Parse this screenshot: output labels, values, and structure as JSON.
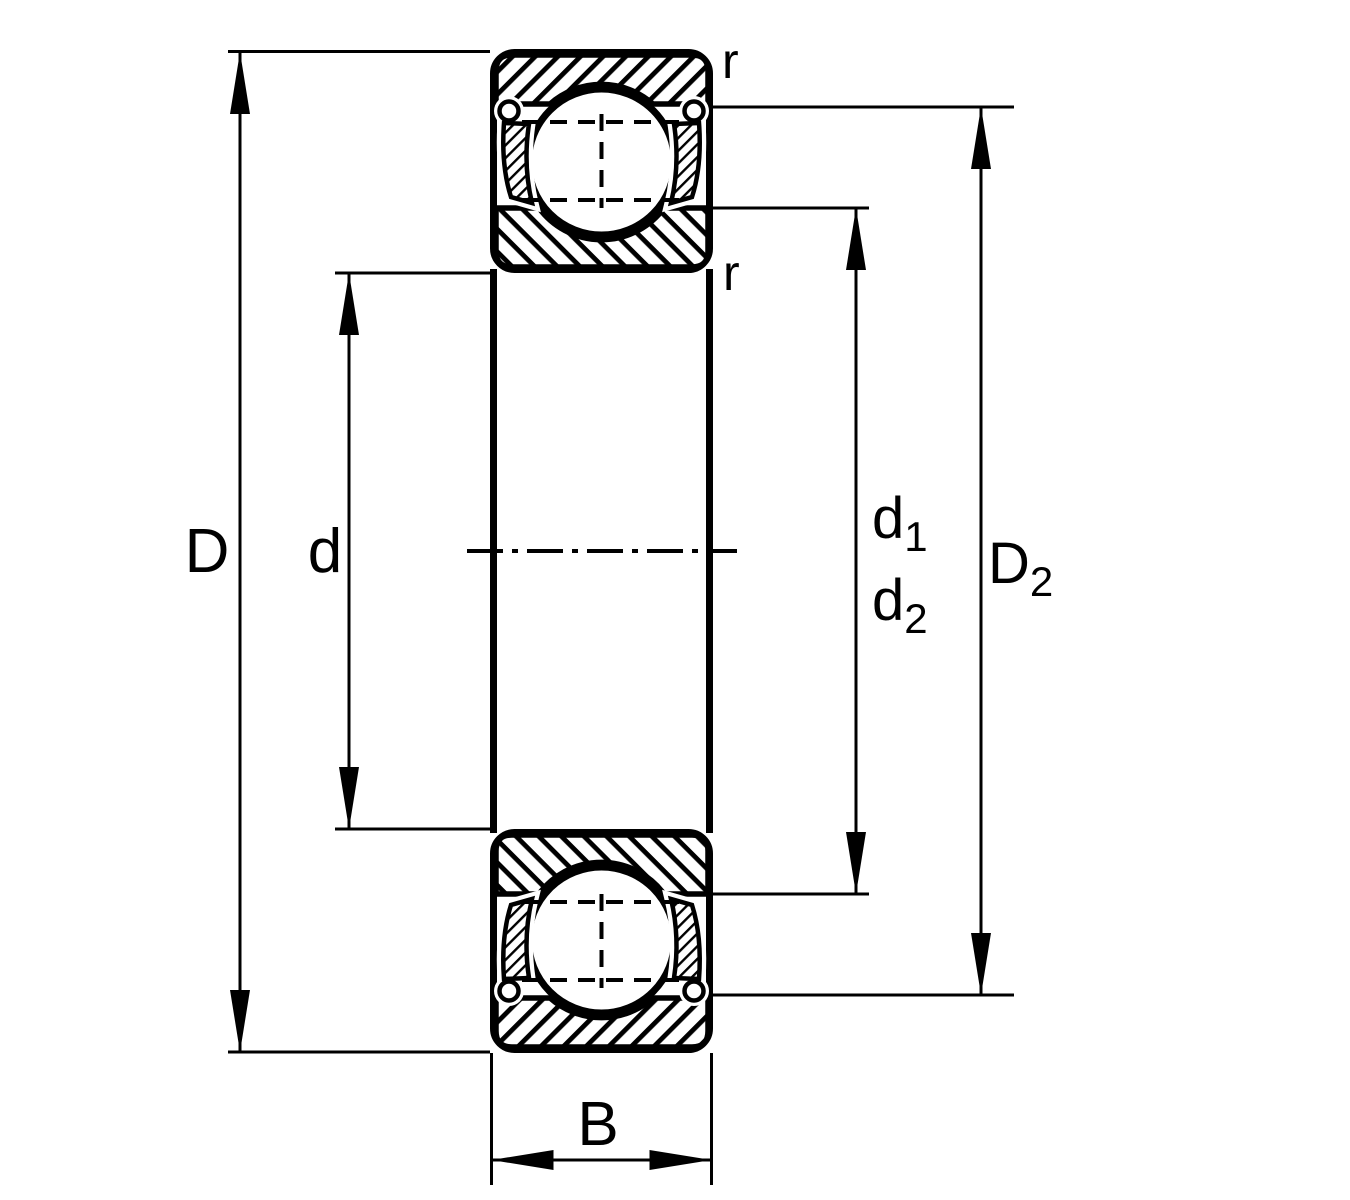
{
  "page": {
    "background": "#ffffff"
  },
  "drawing": {
    "ink": "#000000",
    "description_labels": {
      "outer_diameter": "D",
      "bore_diameter": "d",
      "d1": {
        "base": "d",
        "sub": "1"
      },
      "d2": {
        "base": "d",
        "sub": "2"
      },
      "D2": {
        "base": "D",
        "sub": "2"
      },
      "width": "B",
      "r_outer": "r",
      "r_inner": "r"
    }
  }
}
